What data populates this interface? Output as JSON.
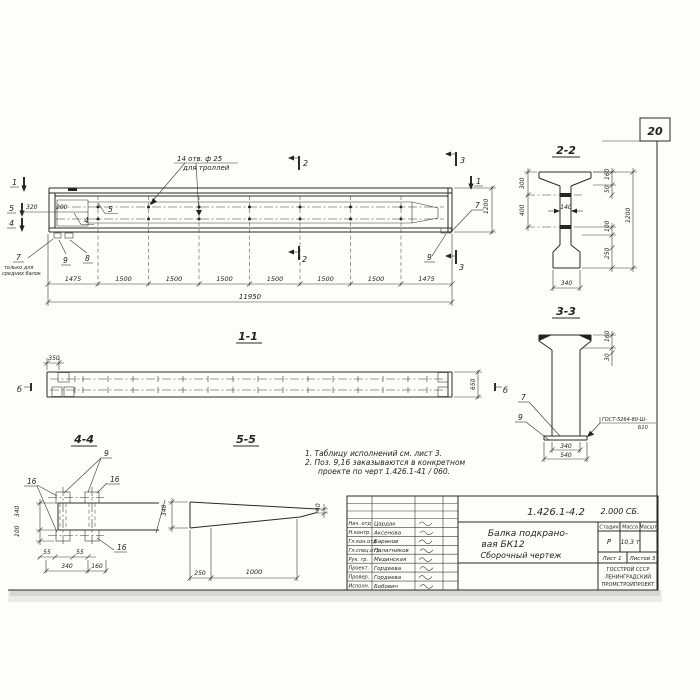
{
  "sheet": {
    "number": "20"
  },
  "main_view": {
    "holes_callout_line1": "14 отв. ф 25",
    "holes_callout_line2": "для троллей",
    "mark_1_left": "1",
    "mark_5_left": "5",
    "mark_4_left": "4",
    "mark_1_right": "1",
    "section_2": "2",
    "section_3": "3",
    "pos_5": "5",
    "pos_4": "4",
    "pos_8": "8",
    "pos_9_left": "9",
    "pos_7_left": "7",
    "pos_7_note_line1": "только для",
    "pos_7_note_line2": "средних балок",
    "pos_7_right": "7",
    "pos_9_right": "9",
    "dim_320": "320",
    "dim_200": "200",
    "dim_1200": "1200",
    "dims_bottom": [
      "1475",
      "1500",
      "1500",
      "1500",
      "1500",
      "1500",
      "1500",
      "1475"
    ],
    "dim_total": "11950"
  },
  "section_2_2": {
    "label": "2-2",
    "dim_300": "300",
    "dim_400": "400",
    "dim_140": "140",
    "dim_160": "160",
    "dim_50": "50",
    "dim_1200": "1200",
    "dim_100": "100",
    "dim_250": "250",
    "dim_340": "340"
  },
  "section_3_3": {
    "label": "3-3",
    "dim_160": "160",
    "dim_30": "30",
    "dim_340": "340",
    "dim_540": "540",
    "pos_7": "7",
    "pos_9": "9",
    "weld_note_line1": "ГОСТ-5264-80-Ш-",
    "weld_note_line2": "Б10"
  },
  "section_1_1": {
    "label": "1-1",
    "dim_350": "350",
    "dim_650": "650",
    "mark_b_left": "б",
    "mark_b_right": "б"
  },
  "view_4_4": {
    "label": "4-4",
    "pos_9": "9",
    "pos_16_left": "16",
    "pos_16_right": "16",
    "pos_16_bottom": "16",
    "dim_340_left": "340",
    "dim_100": "100",
    "dim_55_a": "55",
    "dim_55_b": "55",
    "dim_340_bottom": "340",
    "dim_160": "160"
  },
  "view_5_5": {
    "label": "5-5",
    "dim_340": "340",
    "dim_40": "40",
    "dim_250": "250",
    "dim_1000": "1000"
  },
  "notes": {
    "line1": "1. Таблицу исполнений см. лист 3.",
    "line2": "2. Поз. 9,16 заказываются в конкретном",
    "line3": "проекте по черт 1.426.1-41 / 060."
  },
  "title_block": {
    "doc_number": "1.426.1-4.2",
    "doc_code": "2.000 СБ.",
    "title_line1": "Балка подкрано-",
    "title_line2": "вая БК12",
    "title_line3": "Сборочный чертеж",
    "stage_label": "Стадия",
    "mass_label": "Масса",
    "scale_label": "Масшт.",
    "stage_value": "Р",
    "mass_value": "10,3 т",
    "sheet_info": "Лист 1",
    "sheets_info": "Листов 3",
    "org_line1": "ГОССТРОЙ СССР",
    "org_line2": "ЛЕНИНГРАДСКИЙ",
    "org_line3": "ПРОМСТРОЙПРОЕКТ",
    "signers": [
      {
        "role": "Нач. отд",
        "name": "Цардак"
      },
      {
        "role": "Н.контр.",
        "name": "Аксенова"
      },
      {
        "role": "Гл.кон.отд",
        "name": "Баранов"
      },
      {
        "role": "Гл.спец.отд",
        "name": "Палатников"
      },
      {
        "role": "Рук. гр.",
        "name": "Мединская"
      },
      {
        "role": "Проект.",
        "name": "Гордеева"
      },
      {
        "role": "Провер.",
        "name": "Гордеева"
      },
      {
        "role": "Исполн.",
        "name": "Бобович"
      }
    ]
  }
}
